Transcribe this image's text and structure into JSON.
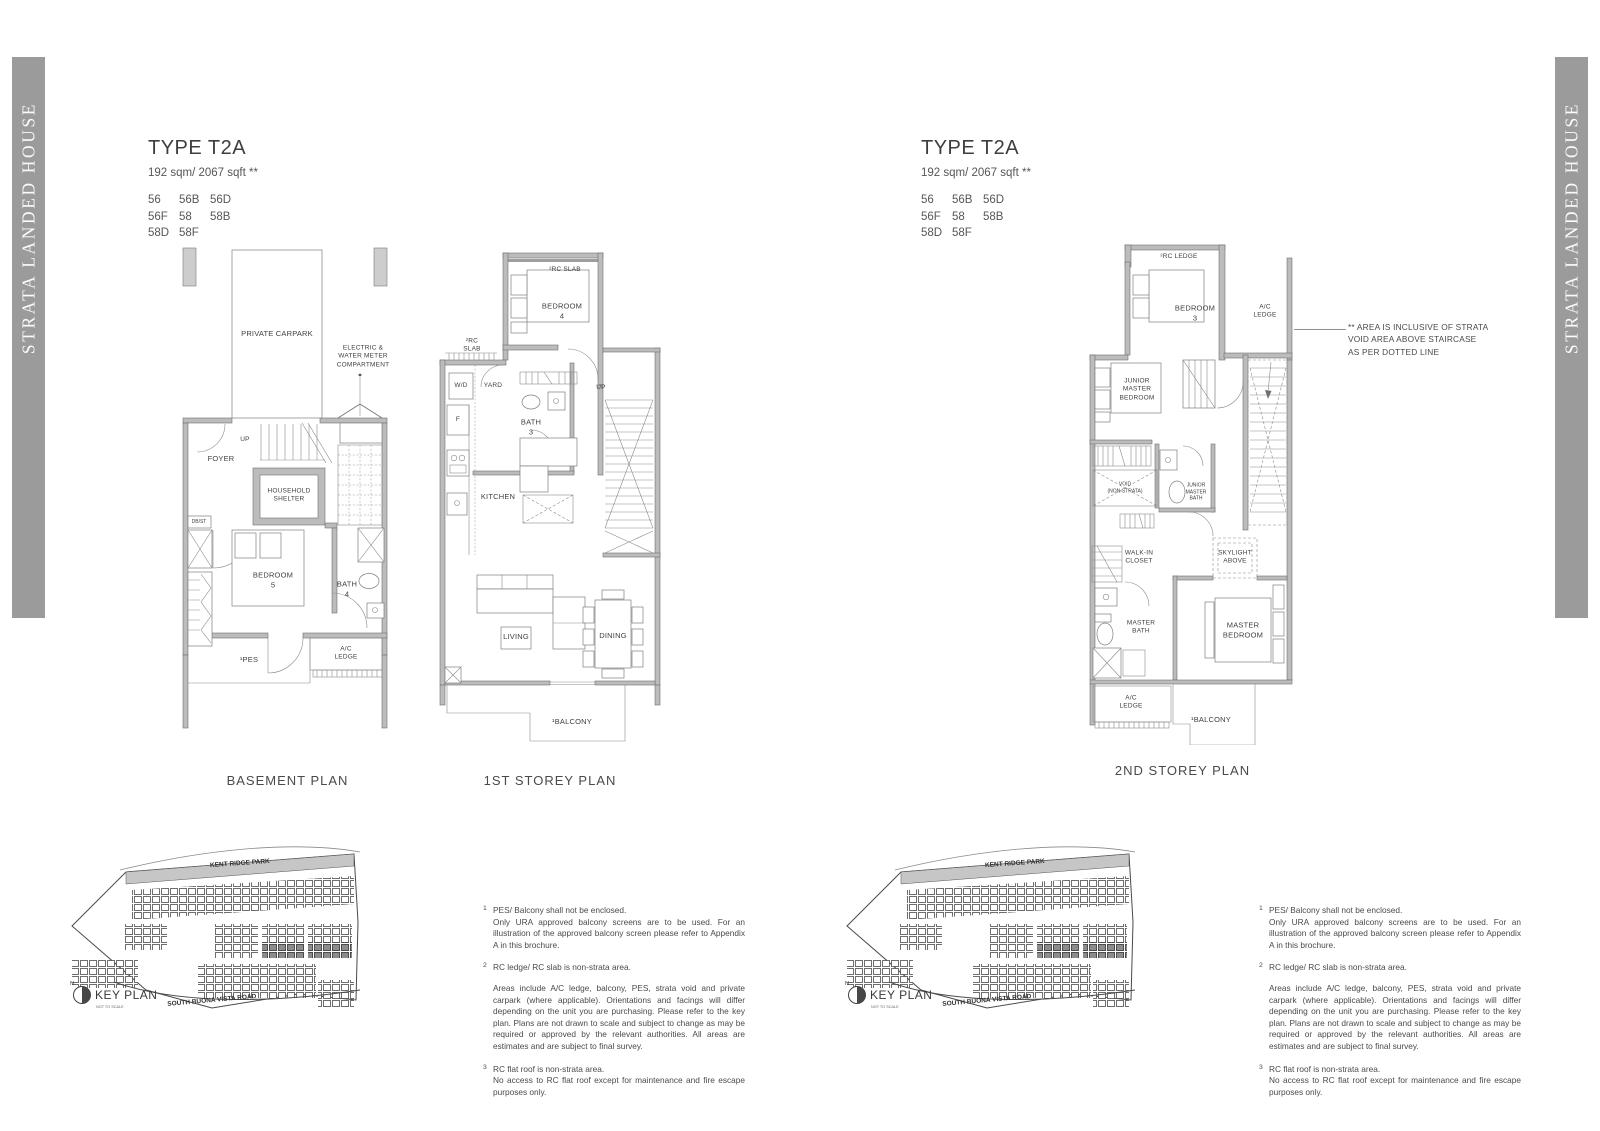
{
  "sidebar_title": "STRATA LANDED HOUSE",
  "header": {
    "type_label": "TYPE T2A",
    "area_label": "192 sqm/ 2067 sqft **",
    "unit_rows": [
      [
        "56",
        "56B",
        "56D"
      ],
      [
        "56F",
        "58",
        "58B"
      ],
      [
        "58D",
        "58F"
      ]
    ]
  },
  "plans": {
    "basement": {
      "caption": "BASEMENT PLAN",
      "labels": {
        "carpark": "PRIVATE CARPARK",
        "meter": "ELECTRIC &\nWATER METER\nCOMPARTMENT",
        "up": "UP",
        "foyer": "FOYER",
        "shelter": "HOUSEHOLD\nSHELTER",
        "dbst": "DB/ST",
        "bedroom5": "BEDROOM\n5",
        "bath4": "BATH\n4",
        "pes": "¹PES",
        "acledge": "A/C\nLEDGE"
      }
    },
    "first": {
      "caption": "1ST STOREY PLAN",
      "labels": {
        "rcslab_top": "²RC SLAB",
        "bedroom4": "BEDROOM\n4",
        "rcslab_left": "²RC\nSLAB",
        "wd": "W/D",
        "yard": "YARD",
        "fridge": "F",
        "bath3": "BATH\n3",
        "kitchen": "KITCHEN",
        "up": "UP",
        "living": "LIVING",
        "dining": "DINING",
        "balcony": "¹BALCONY"
      }
    },
    "second": {
      "caption": "2ND STOREY PLAN",
      "labels": {
        "rcledge": "²RC LEDGE",
        "bedroom3": "BEDROOM\n3",
        "acledge_top": "A/C\nLEDGE",
        "jr_bedroom": "JUNIOR\nMASTER\nBEDROOM",
        "void": "VOID\n(NON-STRATA)",
        "jr_bath": "JUNIOR\nMASTER\nBATH",
        "closet": "WALK-IN\nCLOSET",
        "skylight": "SKYLIGHT\nABOVE",
        "master_bath": "MASTER\nBATH",
        "master_bedroom": "MASTER\nBEDROOM",
        "acledge_bottom": "A/C\nLEDGE",
        "balcony": "¹BALCONY"
      }
    }
  },
  "annotation": "** AREA IS INCLUSIVE OF STRATA\nVOID AREA ABOVE STAIRCASE\nAS PER DOTTED LINE",
  "keyplan": {
    "park": "KENT RIDGE PARK",
    "road": "SOUTH BUONA VISTA ROAD",
    "title": "KEY PLAN",
    "scale_note": "NOT TO SCALE",
    "north": "N"
  },
  "footnotes": [
    {
      "num": "1",
      "title": "PES/ Balcony shall not be enclosed.",
      "body": "Only URA approved balcony screens are to be used. For an illustration of the approved balcony screen please refer to Appendix A in this brochure."
    },
    {
      "num": "2",
      "title": "RC ledge/ RC slab is non-strata area.",
      "body": "Areas include A/C ledge, balcony, PES, strata void and private carpark (where applicable). Orientations and facings will differ depending on the unit you are purchasing. Please refer to the key plan. Plans are not drawn to scale and subject to change as may be required or approved by the relevant authorities. All areas are estimates and are subject to final survey."
    },
    {
      "num": "3",
      "title": "RC flat roof is non-strata area.",
      "body": "No access to RC flat roof except for maintenance and fire escape purposes only."
    }
  ],
  "colors": {
    "sidebar_gray": "#9b9b9b",
    "wall_gray": "#bcbcbc",
    "highlight_block_gray": "#8c8c8c"
  }
}
